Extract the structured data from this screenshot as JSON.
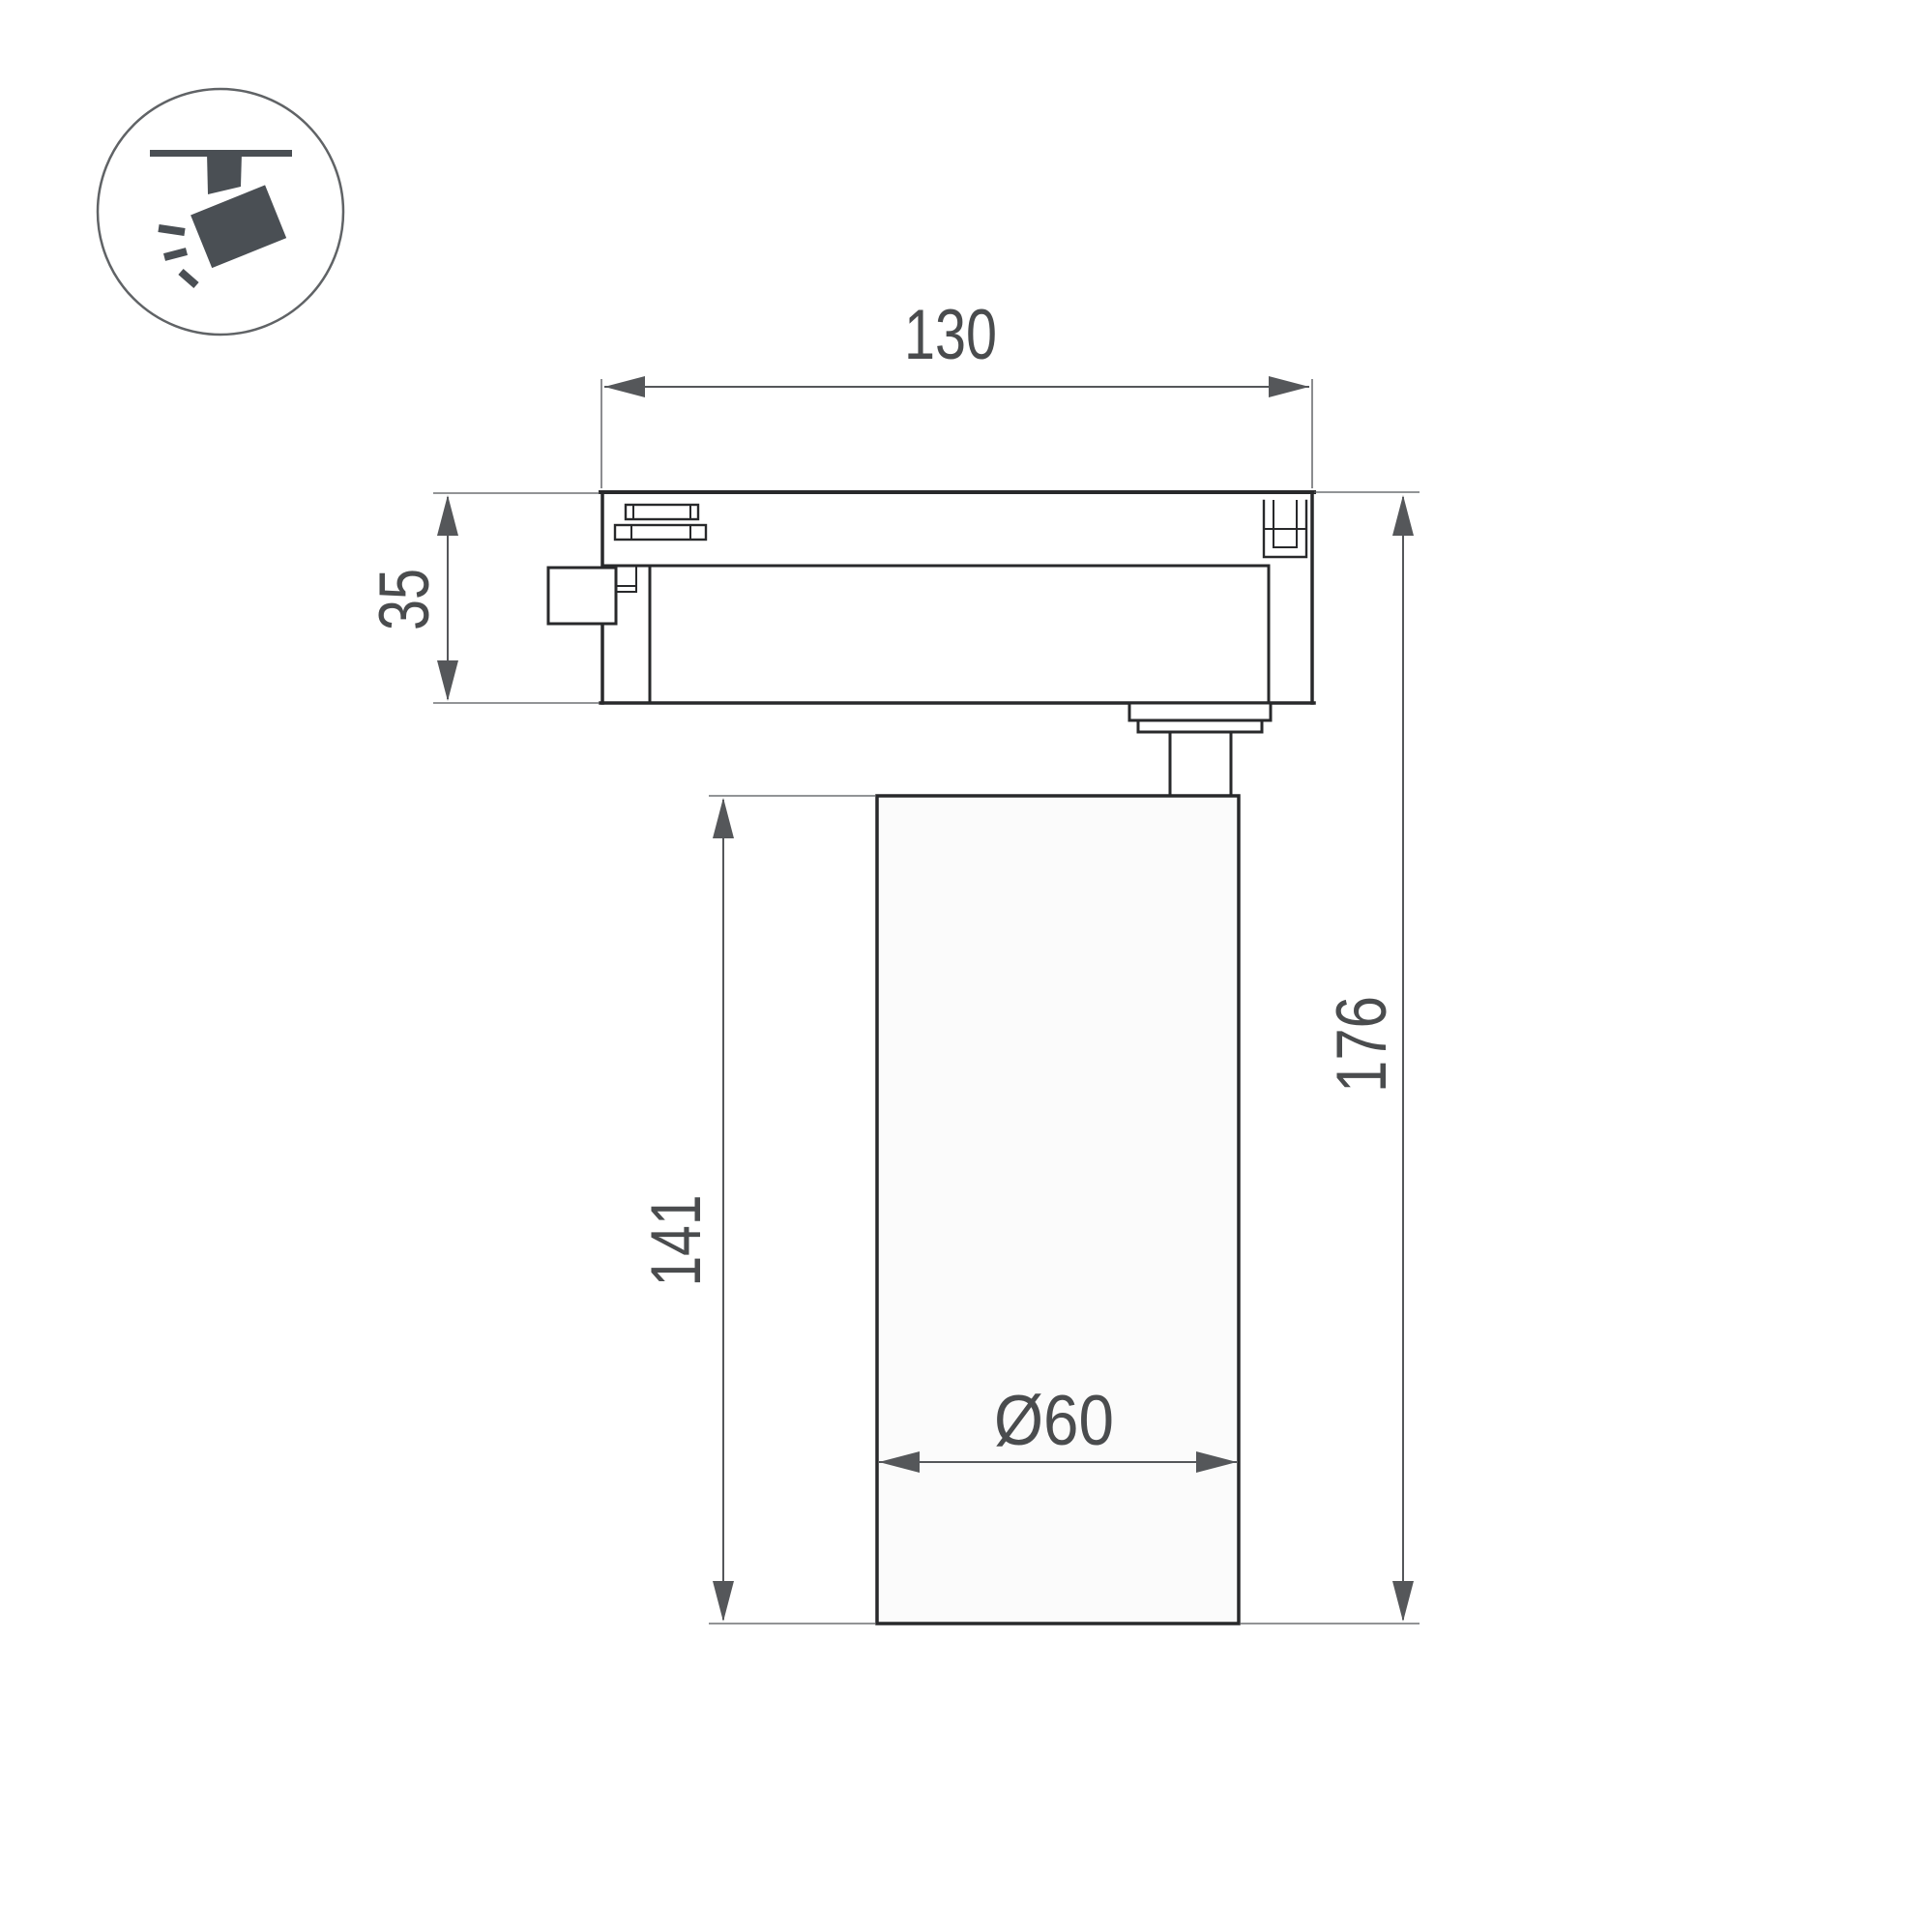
{
  "icon": {
    "name": "track-spotlight-icon"
  },
  "dimensions": {
    "track_adapter_length": "130",
    "track_adapter_height": "35",
    "lamp_body_height": "141",
    "overall_height": "176",
    "lamp_body_diameter": "Ø60"
  },
  "colors": {
    "background": "#ffffff",
    "outline": "#28292b",
    "dimension": "#55575a",
    "dimension-text": "#4a4c4e",
    "icon": "#4a4f54",
    "icon-ring": "#606366",
    "body-fill": "#fbfbfb"
  }
}
